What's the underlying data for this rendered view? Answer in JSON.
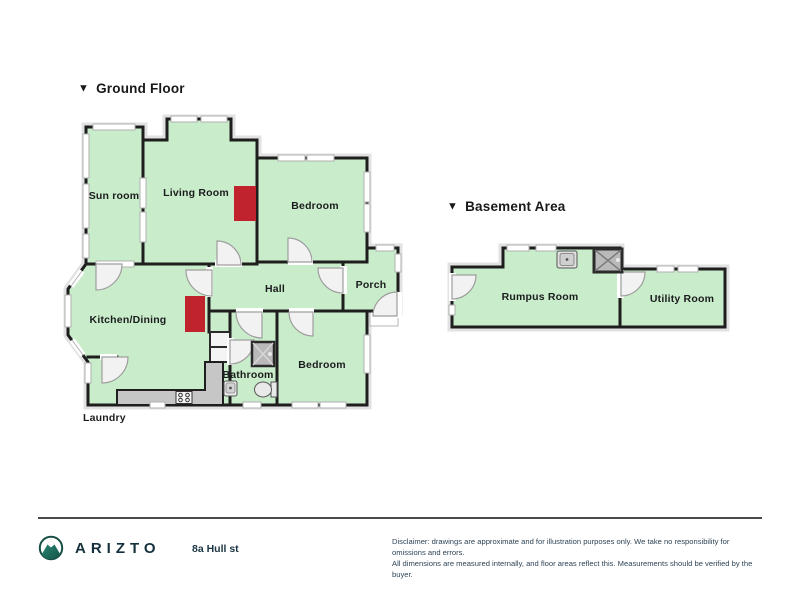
{
  "ground_floor": {
    "marker": "▼",
    "title": "Ground Floor",
    "rooms": {
      "sun_room": "Sun room",
      "living_room": "Living Room",
      "bedroom_top": "Bedroom",
      "hall": "Hall",
      "porch": "Porch",
      "kitchen_dining": "Kitchen/Dining",
      "bathroom": "Bathroom",
      "bedroom_lower": "Bedroom",
      "laundry": "Laundry"
    }
  },
  "basement": {
    "marker": "▼",
    "title": "Basement Area",
    "rooms": {
      "rumpus": "Rumpus Room",
      "utility": "Utility Room"
    }
  },
  "icons": {
    "logo": "mountain-in-circle",
    "fixtures": [
      "shower",
      "toilet",
      "sink",
      "stove",
      "laundry-tub"
    ]
  },
  "colors": {
    "room_fill": "#c9ecca",
    "wall": "#1e1e1e",
    "fireplace_red": "#c1232e",
    "counter_gray": "#c6c6c6",
    "brand_teal": "#1d7a68",
    "door_leaf": "#f2f2f2"
  },
  "footer": {
    "brand": "ARIZTO",
    "address": "8a Hull st",
    "disclaimer_line1": "Disclaimer: drawings are approximate and for illustration purposes only. We take no responsibility for omissions and errors.",
    "disclaimer_line2": "All dimensions are measured internally, and floor areas reflect this. Measurements should be verified by the buyer."
  }
}
